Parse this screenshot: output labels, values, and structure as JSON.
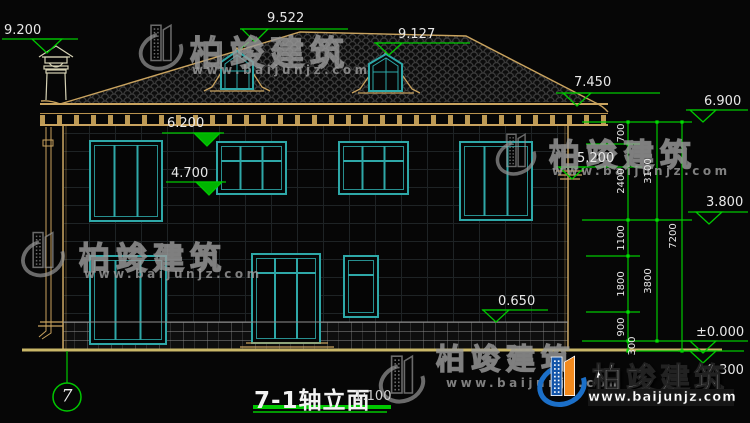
{
  "drawing": {
    "title": "7-1轴立面",
    "scale": "1:100",
    "axis_bubble": "7",
    "elevation_labels": {
      "chimney_top": "9.200",
      "left_dormer_ridge": "9.522",
      "right_dormer_ridge": "9.127",
      "right_eave": "7.450",
      "eave_board": "6.900",
      "second_floor_window_head": "6.200",
      "corner_molding": "5.200",
      "second_floor_window_sill": "4.700",
      "second_floor_level": "3.800",
      "base_course_top": "0.650",
      "first_floor_level": "±0.000",
      "outdoor_ground": "-0.300"
    },
    "dimension_chain_segments": [
      "700",
      "2400",
      "1100",
      "1800",
      "900",
      "300"
    ],
    "dimension_story": [
      "3100",
      "3800"
    ],
    "dimension_total": "7200"
  },
  "watermark": {
    "brand": "柏竣建筑",
    "website": "www.baijunjz.com"
  },
  "logo": {
    "brand": "柏竣建筑",
    "website": "www.baijunjz.com"
  },
  "colors": {
    "dimension_green": "#00c800",
    "frame_teal": "#2ea8a8",
    "outline_tan": "#c9a35f",
    "ground_yellow": "#c9b768",
    "logo_blue": "#1b6fc8",
    "logo_orange": "#f28a1e"
  }
}
